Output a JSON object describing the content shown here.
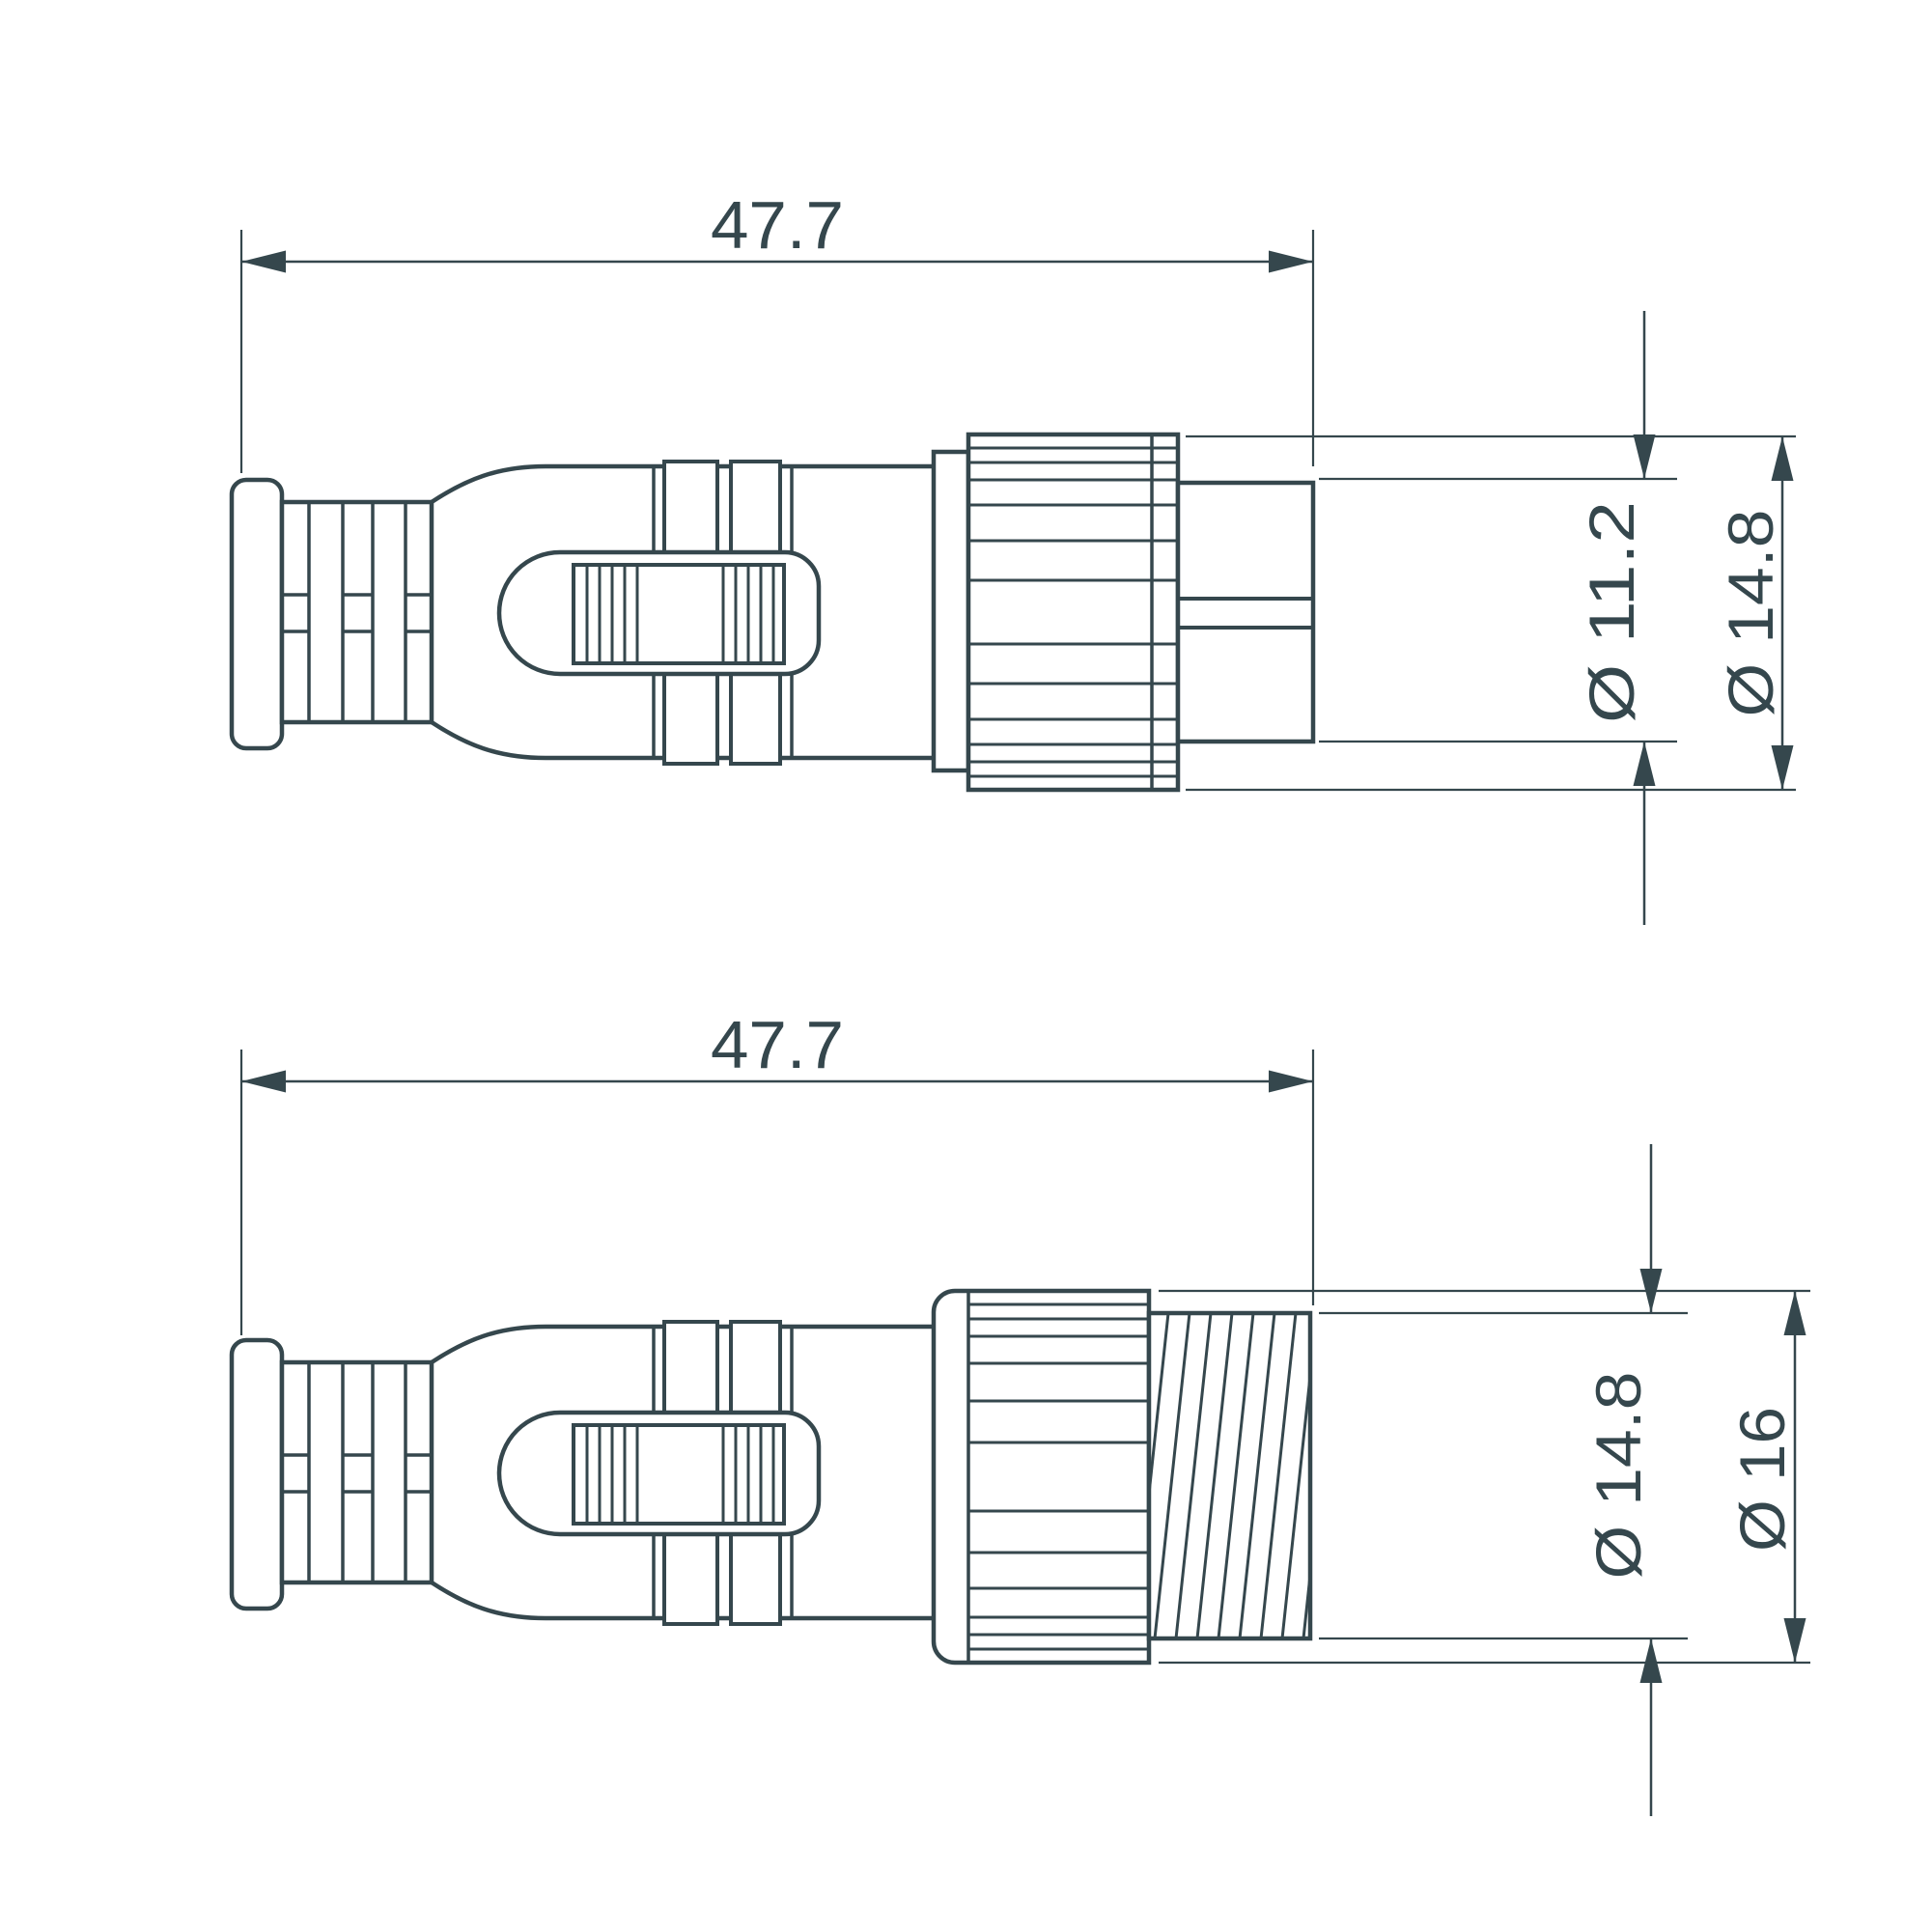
{
  "canvas": {
    "background": "#ffffff",
    "line_color": "#35474D"
  },
  "top_view": {
    "length_label": "47.7",
    "pin_diameter_label": "Ø 11.2",
    "nut_diameter_label": "Ø 14.8"
  },
  "bottom_view": {
    "length_label": "47.7",
    "thread_diameter_label": "Ø 14.8",
    "nut_diameter_label": "Ø 16"
  }
}
